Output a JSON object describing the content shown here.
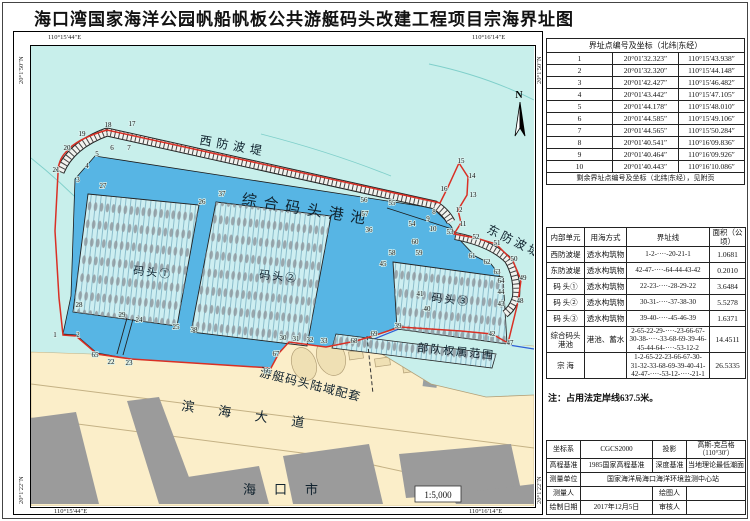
{
  "title": "海口湾国家海洋公园帆船帆板公共游艇码头改建工程项目宗海界址图",
  "note": "注：占用法定岸线637.5米。",
  "map": {
    "scale": "1:5,000",
    "north": "N",
    "corner_coords": {
      "top_left": "110°15′44″E",
      "top_right": "110°16′14″E",
      "bottom_left": "110°15′44″E",
      "bottom_right": "110°16′14″E",
      "left_top": "20°1′50″N",
      "left_bottom": "20°1′22″N",
      "right_top": "20°1′50″N",
      "right_bottom": "20°1′22″N"
    },
    "labels": {
      "west_breakwater": "西防波堤",
      "east_breakwater": "东防波堤",
      "harbor_basin": "综合码头港池",
      "pier1": "码头①",
      "pier2": "码头②",
      "pier3": "码头③",
      "military": "部队权属范围",
      "yacht_land": "游艇码头陆域配套",
      "road": "滨海大道",
      "city": "海口市"
    },
    "points": [
      {
        "n": "1",
        "x": 24,
        "y": 291
      },
      {
        "n": "2",
        "x": 47,
        "y": 291
      },
      {
        "n": "3",
        "x": 47,
        "y": 136
      },
      {
        "n": "4",
        "x": 56,
        "y": 122
      },
      {
        "n": "5",
        "x": 66,
        "y": 110
      },
      {
        "n": "6",
        "x": 81,
        "y": 104
      },
      {
        "n": "7",
        "x": 98,
        "y": 104
      },
      {
        "n": "8",
        "x": 403,
        "y": 168
      },
      {
        "n": "9",
        "x": 397,
        "y": 175
      },
      {
        "n": "10",
        "x": 402,
        "y": 185
      },
      {
        "n": "11",
        "x": 432,
        "y": 180
      },
      {
        "n": "12",
        "x": 428,
        "y": 166
      },
      {
        "n": "13",
        "x": 442,
        "y": 151
      },
      {
        "n": "14",
        "x": 441,
        "y": 132
      },
      {
        "n": "15",
        "x": 430,
        "y": 117
      },
      {
        "n": "16",
        "x": 413,
        "y": 145
      },
      {
        "n": "17",
        "x": 101,
        "y": 80
      },
      {
        "n": "18",
        "x": 77,
        "y": 81
      },
      {
        "n": "19",
        "x": 51,
        "y": 90
      },
      {
        "n": "20",
        "x": 36,
        "y": 104
      },
      {
        "n": "21",
        "x": 25,
        "y": 126
      },
      {
        "n": "22",
        "x": 80,
        "y": 318
      },
      {
        "n": "23",
        "x": 98,
        "y": 319
      },
      {
        "n": "24",
        "x": 108,
        "y": 276
      },
      {
        "n": "25",
        "x": 145,
        "y": 283
      },
      {
        "n": "26",
        "x": 171,
        "y": 158
      },
      {
        "n": "27",
        "x": 72,
        "y": 142
      },
      {
        "n": "28",
        "x": 48,
        "y": 261
      },
      {
        "n": "29",
        "x": 91,
        "y": 271
      },
      {
        "n": "30",
        "x": 252,
        "y": 294
      },
      {
        "n": "31",
        "x": 265,
        "y": 295
      },
      {
        "n": "32",
        "x": 279,
        "y": 296
      },
      {
        "n": "33",
        "x": 293,
        "y": 297
      },
      {
        "n": "36",
        "x": 338,
        "y": 186
      },
      {
        "n": "37",
        "x": 191,
        "y": 150
      },
      {
        "n": "38",
        "x": 163,
        "y": 286
      },
      {
        "n": "39",
        "x": 367,
        "y": 282
      },
      {
        "n": "40",
        "x": 396,
        "y": 265
      },
      {
        "n": "41",
        "x": 389,
        "y": 250
      },
      {
        "n": "42",
        "x": 461,
        "y": 290
      },
      {
        "n": "43",
        "x": 470,
        "y": 260
      },
      {
        "n": "44",
        "x": 470,
        "y": 248
      },
      {
        "n": "45",
        "x": 352,
        "y": 220
      },
      {
        "n": "47",
        "x": 479,
        "y": 299
      },
      {
        "n": "48",
        "x": 489,
        "y": 257
      },
      {
        "n": "49",
        "x": 492,
        "y": 234
      },
      {
        "n": "50",
        "x": 483,
        "y": 215
      },
      {
        "n": "51",
        "x": 466,
        "y": 199
      },
      {
        "n": "52",
        "x": 445,
        "y": 193
      },
      {
        "n": "53",
        "x": 419,
        "y": 188
      },
      {
        "n": "54",
        "x": 381,
        "y": 180
      },
      {
        "n": "55",
        "x": 361,
        "y": 159
      },
      {
        "n": "56",
        "x": 333,
        "y": 156
      },
      {
        "n": "57",
        "x": 334,
        "y": 170
      },
      {
        "n": "58",
        "x": 361,
        "y": 209
      },
      {
        "n": "59",
        "x": 388,
        "y": 209
      },
      {
        "n": "60",
        "x": 384,
        "y": 198
      },
      {
        "n": "61",
        "x": 441,
        "y": 212
      },
      {
        "n": "62",
        "x": 456,
        "y": 218
      },
      {
        "n": "63",
        "x": 466,
        "y": 228
      },
      {
        "n": "64",
        "x": 470,
        "y": 237
      },
      {
        "n": "65",
        "x": 64,
        "y": 311
      },
      {
        "n": "66",
        "x": 236,
        "y": 327
      },
      {
        "n": "67",
        "x": 245,
        "y": 310
      },
      {
        "n": "68",
        "x": 323,
        "y": 297
      },
      {
        "n": "69",
        "x": 343,
        "y": 290
      }
    ]
  },
  "tables": {
    "boundary_points": {
      "title": "界址点编号及坐标（北纬|东经）",
      "footer": "剩余界址点编号及坐标（北纬|东经），见附页",
      "rows": [
        [
          "1",
          "20°01′32.323″",
          "110°15′43.938″"
        ],
        [
          "2",
          "20°01′32.320″",
          "110°15′44.148″"
        ],
        [
          "3",
          "20°01′42.427″",
          "110°15′46.482″"
        ],
        [
          "4",
          "20°01′43.442″",
          "110°15′47.105″"
        ],
        [
          "5",
          "20°01′44.178″",
          "110°15′48.010″"
        ],
        [
          "6",
          "20°01′44.585″",
          "110°15′49.106″"
        ],
        [
          "7",
          "20°01′44.565″",
          "110°15′50.284″"
        ],
        [
          "8",
          "20°01′40.541″",
          "110°16′09.836″"
        ],
        [
          "9",
          "20°01′40.464″",
          "110°16′09.926″"
        ],
        [
          "10",
          "20°01′40.443″",
          "110°16′10.086″"
        ]
      ]
    },
    "units": {
      "headers": [
        "内部单元",
        "用海方式",
        "界址线",
        "面积（公顷）"
      ],
      "rows": [
        [
          "西防波堤",
          "透水构筑物",
          "1-2-····-20-21-1",
          "1.0681"
        ],
        [
          "东防波堤",
          "透水构筑物",
          "42-47-····-64-44-43-42",
          "0.2010"
        ],
        [
          "码 头①",
          "透水构筑物",
          "22-23-····-28-29-22",
          "3.6484"
        ],
        [
          "码 头②",
          "透水构筑物",
          "30-31-····-37-38-30",
          "5.5278"
        ],
        [
          "码 头③",
          "透水构筑物",
          "39-40-····-45-46-39",
          "1.6371"
        ],
        [
          "综合码头港池",
          "港池、蓄水",
          "2-65-22-29-····-23-66-67-\n30-38-····-33-68-69-39-46-\n45-44-64-····-53-12-2",
          "14.4511"
        ],
        [
          "宗 海",
          "",
          "1-2-65-22-23-66-67-30-\n31-32-33-68-69-39-40-41-\n42-47-····-53-12-····-21-1",
          "26.5335"
        ]
      ]
    },
    "meta": {
      "coord_label": "坐标系",
      "coord_value": "CGCS2000",
      "proj_label": "投影",
      "proj_value": "高斯-克吕格（110°30′）",
      "elev_label": "高程基准",
      "elev_value": "1985国家高程基准",
      "depth_label": "深度基准",
      "depth_value": "当地理论最低潮面",
      "survey_unit_label": "测量单位",
      "survey_unit_value": "国家海洋局海口海洋环境监测中心站",
      "surveyor_label": "测量人",
      "surveyor_value": "",
      "draftsman_label": "绘图人",
      "draftsman_value": "",
      "date_label": "绘制日期",
      "date_value": "2017年12月5日",
      "reviewer_label": "审核人",
      "reviewer_value": ""
    }
  },
  "colors": {
    "sea": "#c8efeb",
    "harbor_basin": "#57b5e4",
    "land": "#fbeec9",
    "boundary_red": "#d93025",
    "military_blue_edge": "#2e5fd6",
    "building_gray": "#9b9b9b"
  }
}
